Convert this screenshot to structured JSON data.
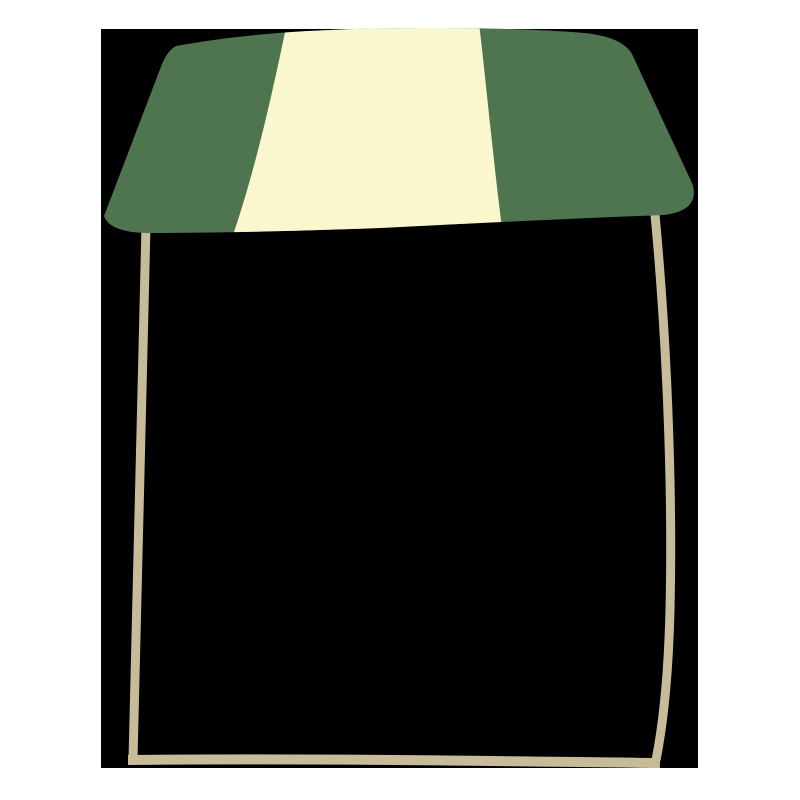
{
  "scene": {
    "background_color": "#ffffff",
    "colors": {
      "green": "#4e7450",
      "cream": "#faf6ce",
      "tan": "#c8bb97",
      "black": "#000000"
    },
    "backdrop": {
      "x": "101",
      "y": "29",
      "width": "597",
      "height": "739",
      "color": "#000000"
    },
    "paths": {
      "awning_outline": "M 176,46 C 240,34 320,28 430,28 C 500,28 550,30 585,33 Q 622,37 632,54 L 692,183 C 698,200 690,212 664,215 C 560,219 480,223 380,228 C 300,231 220,233 150,233 Q 110,233 104,216 L 162,64 Q 168,50 176,46 Z",
      "cream_stripe": "M 288,18 L 478,16 C 484,60 492,150 502,228 L 232,238 C 257,165 274,85 288,18 Z",
      "left_leg": "M 146,226 C 143,360 139,560 133,760",
      "right_leg": "M 655,215 C 666,330 673,480 670,610 C 668,690 661,735 656,760",
      "bottom_bar": "M 128,760 C 300,758 480,761 660,763"
    },
    "stroke_widths": {
      "leg": "9",
      "bar": "10"
    }
  }
}
